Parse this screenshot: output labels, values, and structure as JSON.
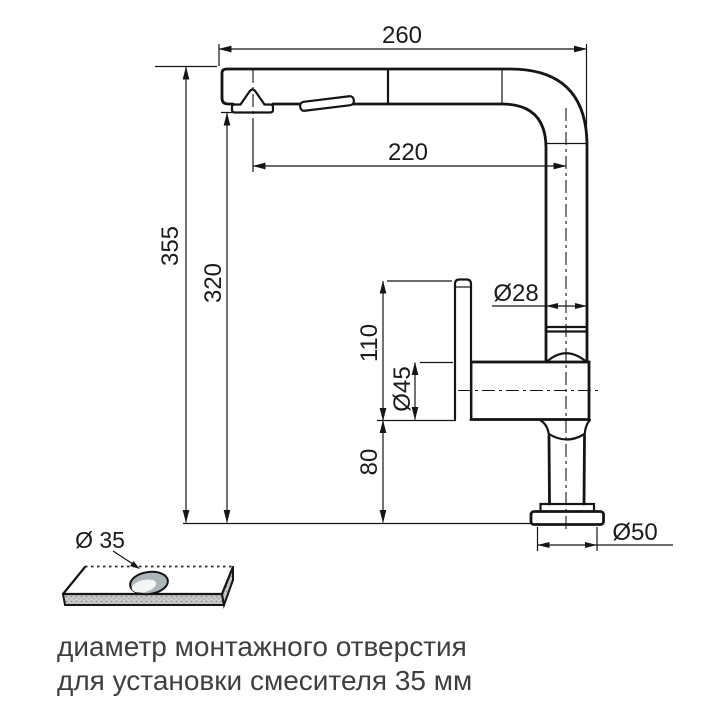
{
  "drawing": {
    "dims": {
      "spout_reach": "260",
      "spout_inner_reach": "220",
      "total_height": "355",
      "spout_height": "320",
      "riser_diameter": "Ø28",
      "upper_body_height": "110",
      "body_diameter": "Ø45",
      "lower_body_height": "80",
      "base_diameter": "Ø50",
      "mounting_hole": "Ø 35"
    },
    "caption": {
      "line1": "диаметр монтажного отверстия",
      "line2": "для установки смесителя 35 мм"
    },
    "colors": {
      "line": "#151515",
      "dim_text": "#1b1b1b",
      "caption_text": "#3f3f3f",
      "plate_face": "#c9c9c9",
      "hole_fill": "#aeb5b8",
      "background": "#ffffff"
    }
  }
}
